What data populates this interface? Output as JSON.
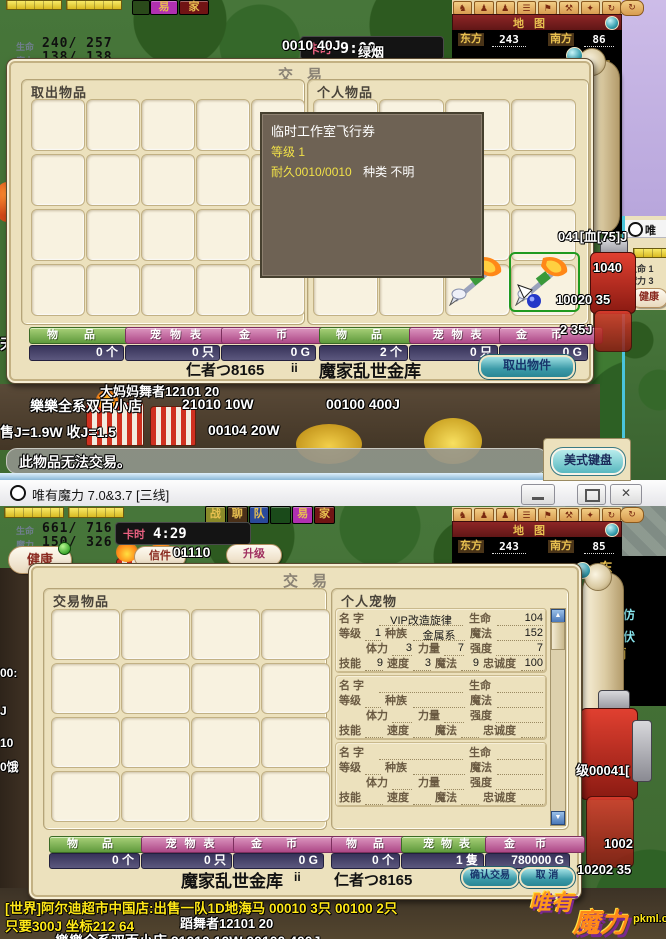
{
  "colors": {
    "parchment": "#ece1bd",
    "button_green": "#5f9a3c",
    "button_pink": "#ad4886",
    "count_bar_navy": "#4c4870",
    "teal_button": "#3b9aa8",
    "map_bar_red": "#7a1f1f",
    "map_gold": "#e8c050",
    "tooltip_bg": "#6e6254",
    "tooltip_yellow": "#f0e048",
    "chat_yellow": "#ffe818"
  },
  "top_client": {
    "hud": {
      "hp_label": "生命",
      "hp_value": "240/ 257",
      "mp_label": "魔力",
      "mp_value": "138/ 138",
      "clock_label": "卡时",
      "clock_value": "9:00",
      "btn_health": "健康",
      "btn_mail": "信件",
      "btn_upgrade": "升级"
    },
    "menu": [
      {
        "label": "易"
      },
      {
        "label": "家"
      }
    ],
    "map": {
      "title": "地图",
      "east_label": "东方",
      "east_value": "243",
      "south_label": "南方",
      "south_value": "86",
      "tile_east": "东",
      "tile_south": "南"
    },
    "trade": {
      "title": "交易",
      "left_panel_title": "取出物品",
      "right_panel_title": "个人物品",
      "items_label": "物品",
      "pets_label": "宠物表",
      "gold_label": "金币",
      "left_items_count": "0 个",
      "left_pets_count": "0 只",
      "left_gold_count": "0 G",
      "right_items_count": "2 个",
      "right_pets_count": "0 只",
      "right_gold_count": "0 G",
      "my_name": "仁者つ8165",
      "names_sep": "ii",
      "partner_name": "魔家乱世金库",
      "takeout_button": "取出物件"
    },
    "tooltip": {
      "name": "临时工作室飞行券",
      "level": "等级 1",
      "durability": "耐久0010/0010",
      "kind": "种类 不明"
    },
    "floats": {
      "price1": "0010  40J",
      "player": "绿烟",
      "shop_name": "樂樂全系双百小店",
      "shop_price1": "21010 10W",
      "shop_price2": "00100  400J",
      "rates": "售J=1.9W 收J=1.5",
      "rate_price": "00104   20W",
      "occluded_player": "大妈妈舞者12101 20",
      "right1": "041[血[75]J",
      "right2": "1040",
      "right3": "10020 35",
      "right4": "2 35J",
      "left_edge": "天"
    },
    "system_message": "此物品无法交易。",
    "ime_indicator": "美式键盘",
    "side_window": {
      "title_char": "唯",
      "hp": "生命 1",
      "mp": "魔力 3",
      "health_btn": "健康"
    }
  },
  "bottom_client": {
    "titlebar": {
      "title": "唯有魔力 7.0&3.7 [三线]"
    },
    "menu": [
      {
        "label": "战"
      },
      {
        "label": "聊"
      },
      {
        "label": "队"
      },
      {
        "label": ""
      },
      {
        "label": "易"
      },
      {
        "label": "家"
      }
    ],
    "hud": {
      "hp_label": "生命",
      "hp_value": "661/ 716",
      "mp_label": "魔力",
      "mp_value": "150/ 326",
      "clock_label": "卡时",
      "clock_value": "4:29",
      "btn_health": "健康",
      "btn_mail": "信件",
      "btn_upgrade": "升级"
    },
    "map": {
      "title": "地图",
      "east_label": "东方",
      "east_value": "243",
      "south_label": "南方",
      "south_value": "85",
      "tile_east": "东",
      "tile_south": "南"
    },
    "trade": {
      "title": "交易",
      "left_panel_title": "交易物品",
      "right_panel_title": "个人宠物",
      "pet_labels": {
        "name": "名 字",
        "hp": "生命",
        "level": "等级",
        "race": "种族",
        "mp": "魔法",
        "stamina": "体力",
        "strength": "力量",
        "toughness": "强度",
        "skill": "技能",
        "speed": "速度",
        "magic": "魔法",
        "loyalty": "忠诚度"
      },
      "pets": [
        {
          "name": "VIP改造旋律",
          "hp": "104",
          "level": "1",
          "race": "金属系",
          "mp": "152",
          "stamina": "3",
          "strength": "7",
          "toughness": "7",
          "skill": "9",
          "speed": "3",
          "magic": "9",
          "loyalty": "100"
        },
        {
          "name": "",
          "hp": "",
          "level": "",
          "race": "",
          "mp": "",
          "stamina": "",
          "strength": "",
          "toughness": "",
          "skill": "",
          "speed": "",
          "magic": "",
          "loyalty": ""
        },
        {
          "name": "",
          "hp": "",
          "level": "",
          "race": "",
          "mp": "",
          "stamina": "",
          "strength": "",
          "toughness": "",
          "skill": "",
          "speed": "",
          "magic": "",
          "loyalty": ""
        }
      ],
      "items_label": "物品",
      "pets_label": "宠物表",
      "gold_label": "金币",
      "left_items_count": "0 个",
      "left_pets_count": "0 只",
      "left_gold_count": "0 G",
      "right_items_count": "0 个",
      "right_pets_count": "1 隻",
      "right_gold_count": "780000 G",
      "my_name": "魔家乱世金库",
      "names_sep": "ii",
      "partner_name": "仁者つ8165",
      "confirm_button": "确认交易",
      "cancel_button": "取 消"
    },
    "chat": {
      "line1": "[世界]阿尔迪超市中国店:出售一队1D地海马 00010 3只 00100 2只",
      "line2": "只要300J 坐标212 64",
      "line2_white": "蹈舞者12101 20",
      "clipped": "樂樂全系双百小店    21010 10W      00100  400J"
    },
    "floats": {
      "coords": "01110",
      "right1": "级00041[",
      "right2": "1002",
      "right3": "10202 35",
      "edge1": "[仿",
      "edge2": "[伏",
      "left1": "00:",
      "left2": "J",
      "left3": "10",
      "left4": "0饿"
    },
    "watermark": {
      "line1": "唯有",
      "line2": "魔力",
      "url": "pkml.cn"
    }
  }
}
